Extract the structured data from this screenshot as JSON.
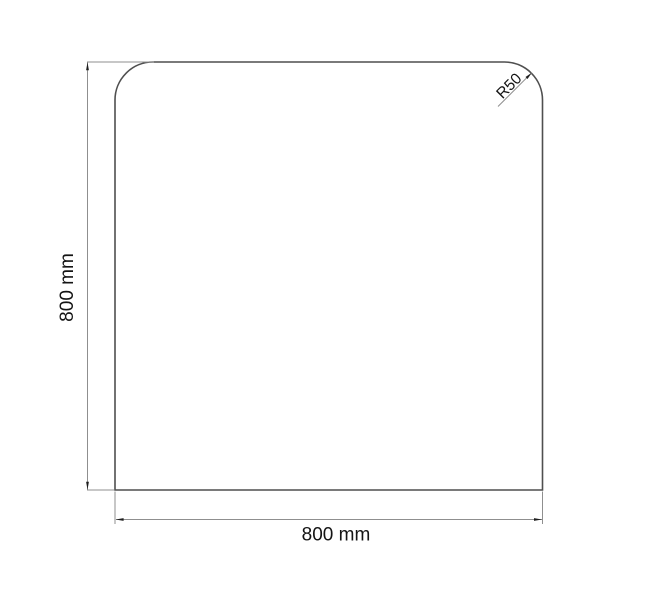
{
  "drawing": {
    "labels": {
      "height": "800 mm",
      "width": "800 mm",
      "corner_radius": "R50"
    },
    "colors": {
      "background": "#ffffff",
      "outline": "#4f4f4f",
      "dimension_line": "#8f8f8f",
      "arrow": "#1f1f1f",
      "label_text": "#141414"
    }
  }
}
